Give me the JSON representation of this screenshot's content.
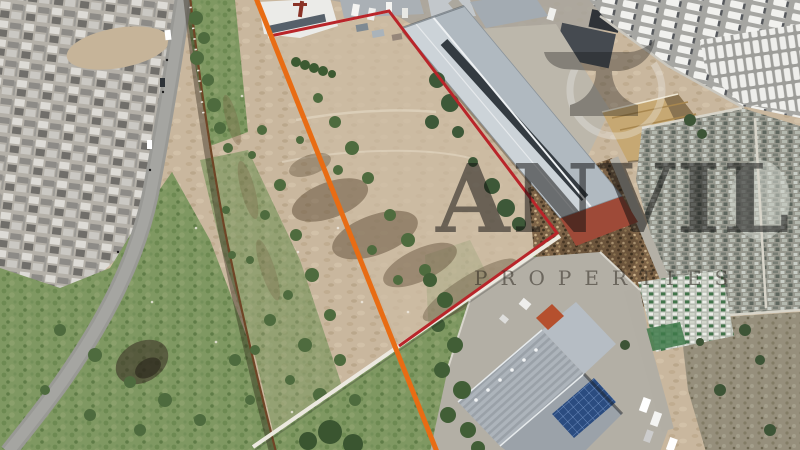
{
  "photo": {
    "kind": "aerial-drone-photo-of-vacant-industrial-site",
    "watermark": {
      "brand": "ANVIL",
      "tagline": "PROPERTIES"
    },
    "outline": {
      "red": "#b9252a",
      "orange": "#e86c14",
      "wall_white": "#ece9e0"
    }
  }
}
